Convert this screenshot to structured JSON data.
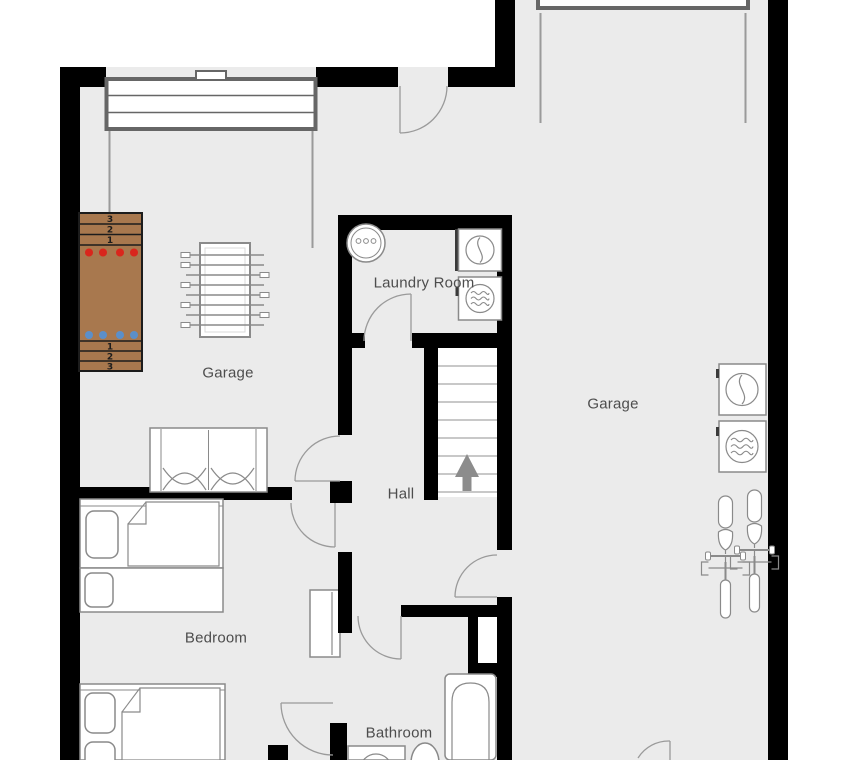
{
  "rooms": {
    "garage_left": {
      "label": "Garage"
    },
    "garage_right": {
      "label": "Garage"
    },
    "laundry": {
      "label": "Laundry Room"
    },
    "hall": {
      "label": "Hall"
    },
    "bedroom": {
      "label": "Bedroom"
    },
    "bathroom": {
      "label": "Bathroom"
    }
  },
  "shuffleboard": {
    "top_scores": [
      "3",
      "2",
      "1"
    ],
    "bottom_scores": [
      "1",
      "2",
      "3"
    ],
    "red_pucks": 4,
    "blue_pucks": 4
  },
  "stairs": {
    "direction": "up",
    "treads": 8
  },
  "objects": [
    "garage-door",
    "garage-door",
    "shuffleboard-table",
    "foosball-table",
    "utility-sink",
    "dryer",
    "washer",
    "double-bed",
    "single-bed",
    "single-bed",
    "double-bed",
    "dresser",
    "bathtub",
    "toilet",
    "washing-machine",
    "dryer",
    "washer",
    "bicycle",
    "bicycle",
    "staircase"
  ],
  "colors": {
    "wall": "#000000",
    "floor": "#ebebeb",
    "line": "#8a8a8a",
    "door_arc": "#9a9a9a",
    "garage_door": "#666666",
    "rail": "#9a9a9a",
    "label_text": "#4d4d4d",
    "shuffleboard_brown": "#a8784e",
    "shuffleboard_line": "#1c1c1c",
    "puck_red": "#d9261c",
    "puck_blue": "#5b8fc9",
    "arrow": "#8c8c8c",
    "stair_tread": "#b5b5b5"
  }
}
